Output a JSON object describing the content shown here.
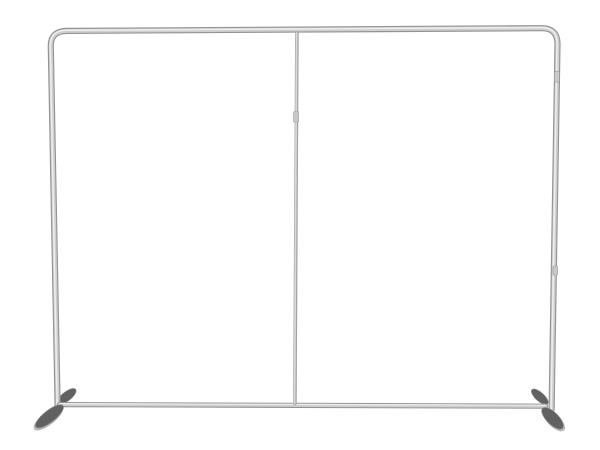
{
  "image": {
    "type": "product-photo",
    "subject": "straight tension-fabric display backdrop frame",
    "description": "Empty silver aluminum tube frame for a straight tension fabric backdrop display: rounded top corners, left and right uprights, bottom crossbar, a thin center support pole with a connector sleeve, and two flat dark-gray stabilizing feet angled toward the viewer at the base of each upright, on a plain white background."
  },
  "colors": {
    "background": "#ffffff",
    "tube_edge": "#949494",
    "tube_mid": "#cfcfcf",
    "tube_highlight": "#eeeeee",
    "pole_edge": "#a3a3a3",
    "pole_mid": "#dadada",
    "joint_fill": "#c9c9c9",
    "joint_edge": "#9a9a9a",
    "foot_dark": "#616161",
    "foot_edge": "#848484",
    "foot_light": "#b8b8b8"
  },
  "frame": {
    "parts": [
      "top-bar",
      "left-upright",
      "right-upright",
      "bottom-crossbar",
      "center-pole",
      "center-pole-joint",
      "right-upright-joint-upper",
      "right-upright-joint-lower",
      "left-foot",
      "right-foot"
    ]
  }
}
